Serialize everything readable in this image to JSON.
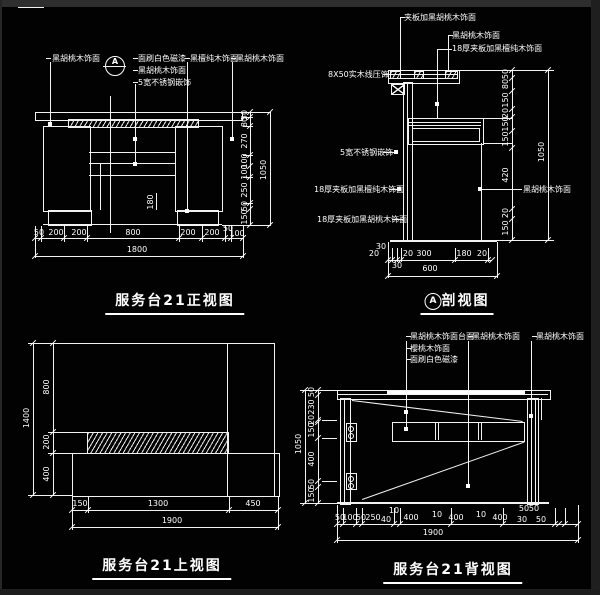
{
  "front": {
    "title": "服务台21正视图",
    "marker": "A",
    "labels": {
      "l1": "黑胡桃木饰面",
      "m1": "面刷白色磁漆",
      "m2": "黑胡桃木饰面",
      "m3": "5宽不锈钢嵌饰",
      "r1": "黑檀纯木饰面",
      "r2": "黑胡桃木饰面"
    },
    "inner_dim": "180",
    "dims_bottom": [
      "50",
      "200",
      "200",
      "800",
      "200",
      "200",
      "50",
      "100"
    ],
    "total_bottom": "1800",
    "dims_right": [
      "50",
      "80",
      "270",
      "100",
      "100",
      "250",
      "50",
      "150"
    ],
    "total_right": "1050"
  },
  "section": {
    "title": "剖视图",
    "marker": "A",
    "labels": {
      "t1": "夹板加黑胡桃木饰面",
      "t2": "黑胡桃木饰面",
      "t3": "18厚夹板加黑檀纯木饰面",
      "l1": "8X50实木线压饰",
      "l2": "5宽不锈钢嵌饰",
      "l3": "18厚夹板加黑檀纯木饰面",
      "l4": "18厚夹板加黑胡桃木饰面",
      "r1": "黑胡桃木饰面"
    },
    "dims_right": [
      "50",
      "80",
      "150",
      "20",
      "150",
      "150",
      "420",
      "20",
      "150"
    ],
    "total_right": "1050",
    "dims_bottom": [
      "20",
      "30",
      "20",
      "300",
      "180",
      "20"
    ],
    "sub_bottom": "30",
    "total_bottom": "600"
  },
  "top": {
    "title": "服务台21上视图",
    "dims_left": [
      "800",
      "200",
      "400"
    ],
    "total_left": "1400",
    "dims_bottom": [
      "150",
      "1300",
      "450"
    ],
    "total_bottom": "1900"
  },
  "back": {
    "title": "服务台21背视图",
    "labels": {
      "t1": "黑胡桃木饰面台面",
      "t2": "樱桃木饰面",
      "t3": "面刷白色磁漆",
      "m1": "黑胡桃木饰面",
      "r1": "黑胡桃木饰面"
    },
    "dims_left": [
      "50",
      "230",
      "20",
      "150",
      "400",
      "50",
      "150"
    ],
    "total_left": "1050",
    "dims_bottom": [
      "50",
      "100",
      "50",
      "250",
      "40",
      "10",
      "400",
      "10",
      "400",
      "10",
      "400",
      "30",
      "50"
    ],
    "stacked": [
      "50",
      "50"
    ],
    "total_bottom": "1900"
  }
}
